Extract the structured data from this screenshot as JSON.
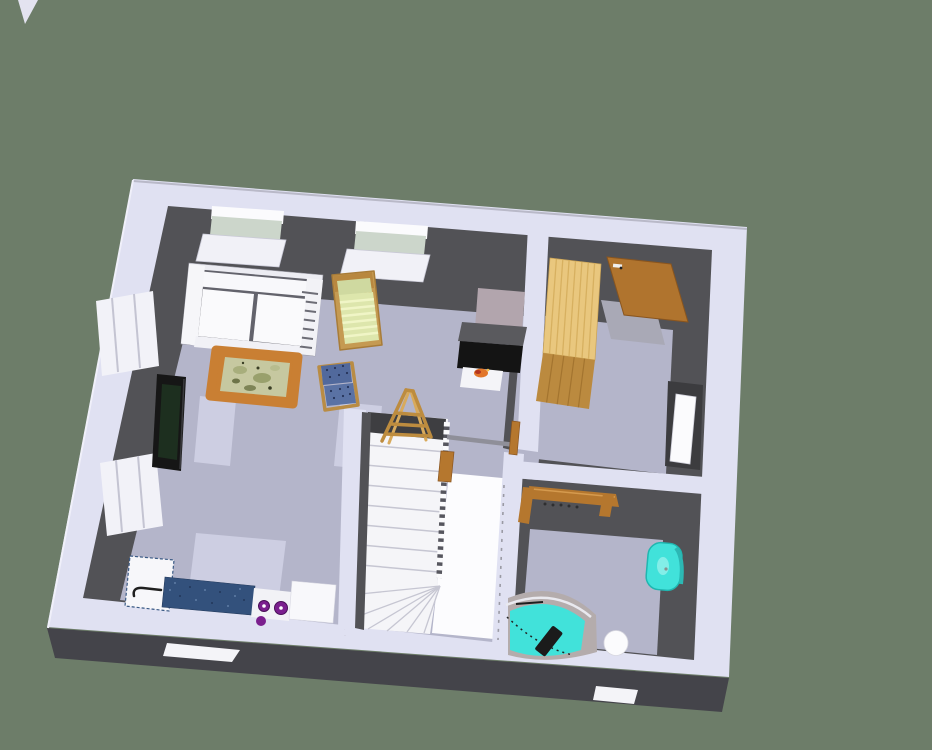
{
  "app": {
    "name": "3d-home-design-render",
    "view": "aerial-dollhouse-floor-plan"
  },
  "colors": {
    "background": "#6d7d69",
    "wall_top": "#e0e1f2",
    "wall_side_light": "#f0f0fa",
    "wall_edge": "#b9b9c8",
    "wall_dark": "#525256",
    "wall_darker": "#3e3e41",
    "floor": "#b4b5ca",
    "floor_light": "#cdcee2",
    "stair_white": "#f5f5f8",
    "stair_bright": "#fcfcfe",
    "ground_shadow": "#44444a",
    "white": "#f7f7fa",
    "wood": "#b5772e",
    "wood_light": "#c59a52",
    "pine_top": "#e9c77e",
    "pine_front": "#bb8a3f",
    "door_wood": "#b0742e",
    "teal": "#41e2da",
    "teal_deep": "#1fb6b0",
    "taupe": "#b4acac",
    "burner_purple": "#7b1f8e",
    "counter_blue": "#33517c",
    "chair_blue": "#51699c",
    "cushion_green": "#dde6ac",
    "cushion_stripe": "#f0f5c6",
    "table_wood": "#c97f33",
    "table_top": "#c6c8a0",
    "tv_black": "#161616",
    "fire_orange": "#e2762a",
    "stove_mauve": "#b2a5ad",
    "glass_green": "#ccd6cb",
    "rail_gray": "#8f8f99",
    "tread_line": "#c6c6d2"
  },
  "scene": {
    "rooms": [
      {
        "name": "living-room",
        "items": [
          "sofa",
          "lounge-chair",
          "blue-armchair",
          "coffee-table",
          "tv-cabinet",
          "wood-stove",
          "step-ladder",
          "window-north-1",
          "window-north-2",
          "window-west-upper",
          "window-west-lower"
        ]
      },
      {
        "name": "kitchen",
        "items": [
          "sink-cabinet",
          "kitchen-faucet",
          "blue-countertop",
          "cooktop-purple-burners",
          "counter-cabinet"
        ]
      },
      {
        "name": "bedroom-upper-right",
        "items": [
          "pine-wardrobe",
          "wood-entry-door",
          "open-white-door"
        ]
      },
      {
        "name": "bathroom",
        "items": [
          "corner-bathtub",
          "bathtub-faucet",
          "pedestal-sink",
          "toilet",
          "towel-rack"
        ]
      },
      {
        "name": "stairwell",
        "items": [
          "u-staircase",
          "winder-treads",
          "baluster-row",
          "gray-handrail",
          "wood-newel-posts"
        ]
      }
    ],
    "exterior": [
      "lawn",
      "ground-shadow",
      "door-step-left",
      "door-step-right"
    ]
  }
}
